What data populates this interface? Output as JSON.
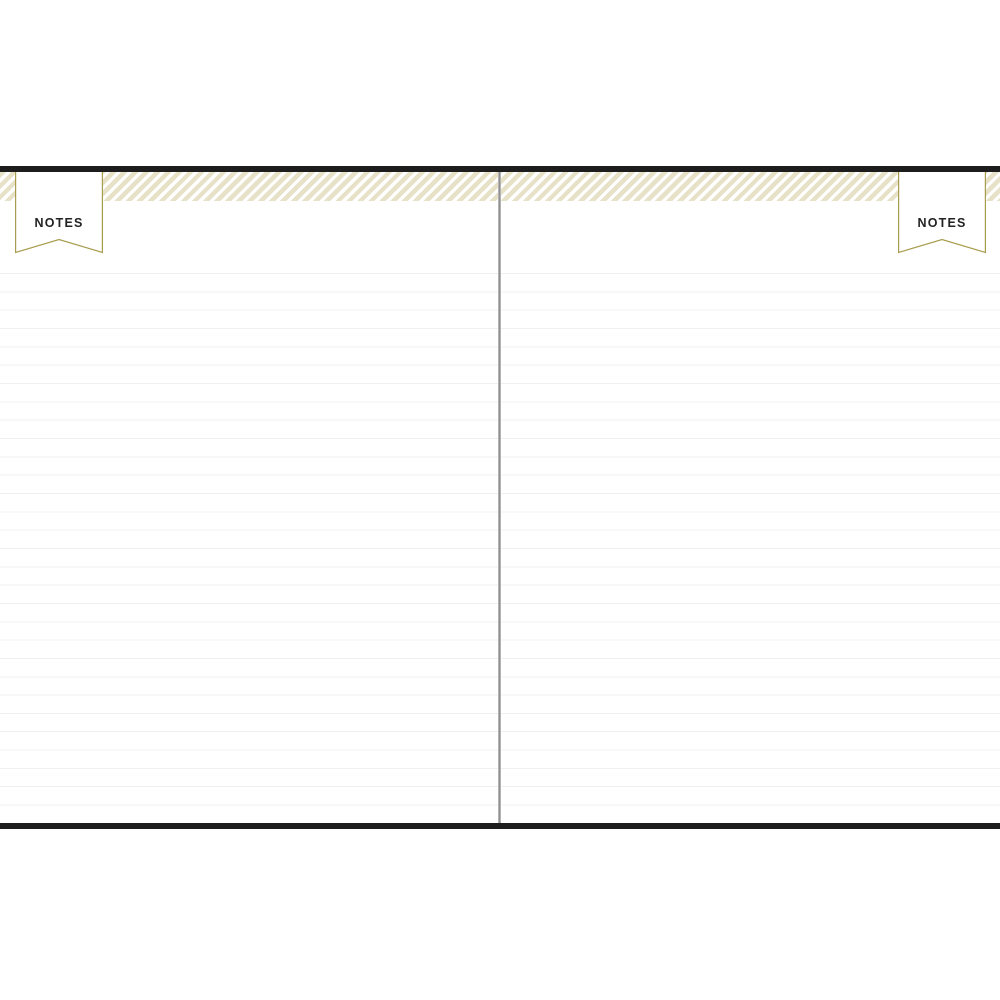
{
  "notebook": {
    "left_banner": {
      "label": "NOTES"
    },
    "right_banner": {
      "label": "NOTES"
    },
    "pages": {
      "rule_count": 30,
      "rule_spacing_px": 18.33,
      "content": ""
    },
    "colors": {
      "paper_white": "#ffffff",
      "cover_black": "#1d1d1d",
      "banner_gold": "#a89c4e",
      "stripe_khaki": "#e7e1c7",
      "rule_line": "#f0f0f0",
      "gutter_gray": "#8f8f8f",
      "label_text": "#232323"
    }
  }
}
